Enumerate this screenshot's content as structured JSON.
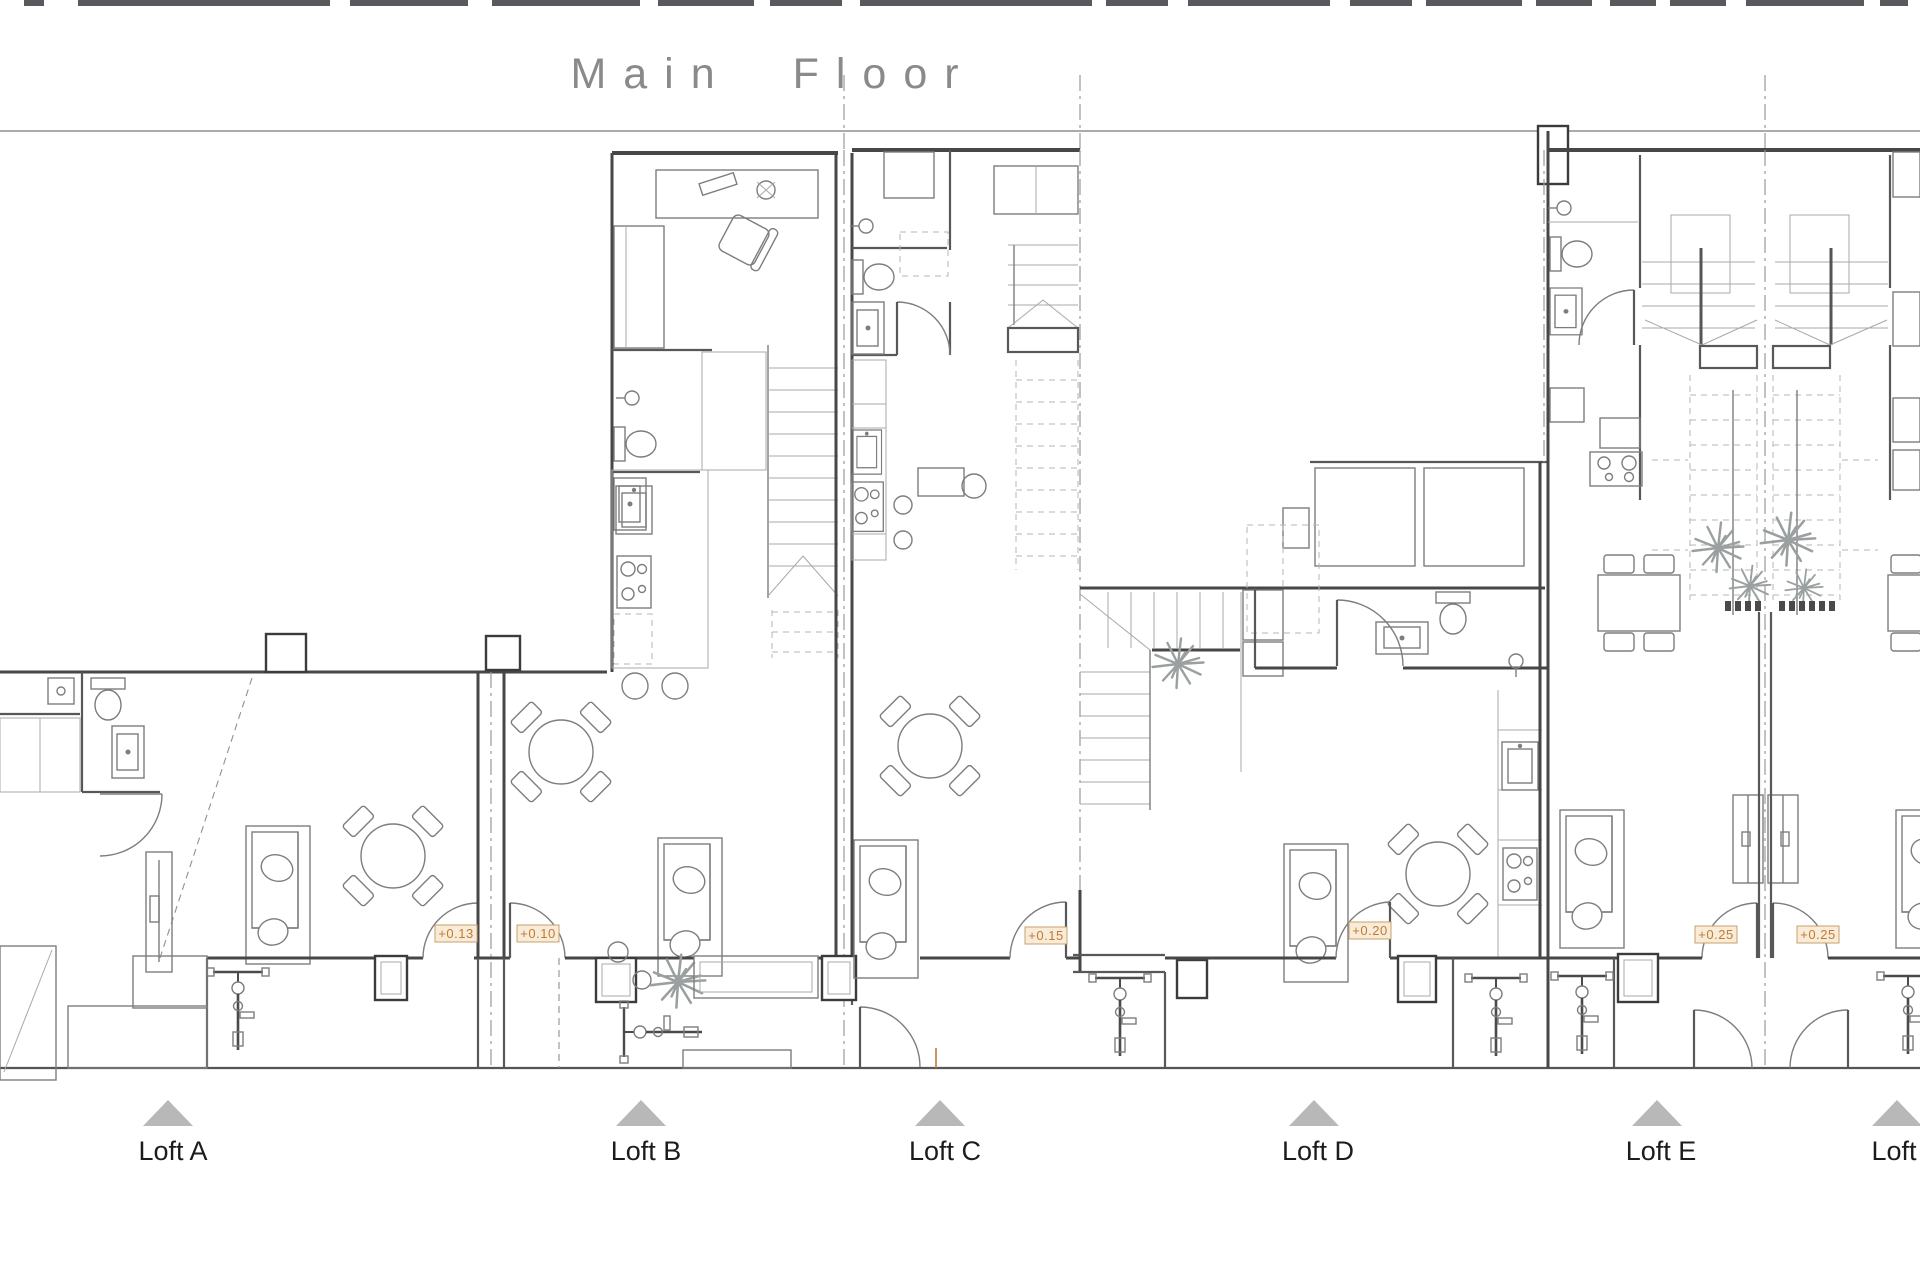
{
  "title": "Main Floor",
  "lofts": [
    {
      "id": "a",
      "label": "Loft A",
      "elevation": "+0.13"
    },
    {
      "id": "b",
      "label": "Loft B",
      "elevation": "+0.10"
    },
    {
      "id": "c",
      "label": "Loft C",
      "elevation": "+0.15"
    },
    {
      "id": "d",
      "label": "Loft D",
      "elevation": "+0.20"
    },
    {
      "id": "e",
      "label": "Loft E",
      "elevation": "+0.25"
    },
    {
      "id": "f",
      "label": "Loft F",
      "elevation": "+0.25"
    }
  ],
  "colors": {
    "wall": "#474747",
    "furniture_line": "#7d7d7d",
    "elevation_text": "#c07a35",
    "elevation_box_fill": "#f8ecd9",
    "elevation_box_border": "#c8a06a",
    "entry_triangle": "#b8b8b8",
    "title_text": "#8a8a8a",
    "label_text": "#1c1c1c",
    "plant": "#9aa0a0"
  }
}
